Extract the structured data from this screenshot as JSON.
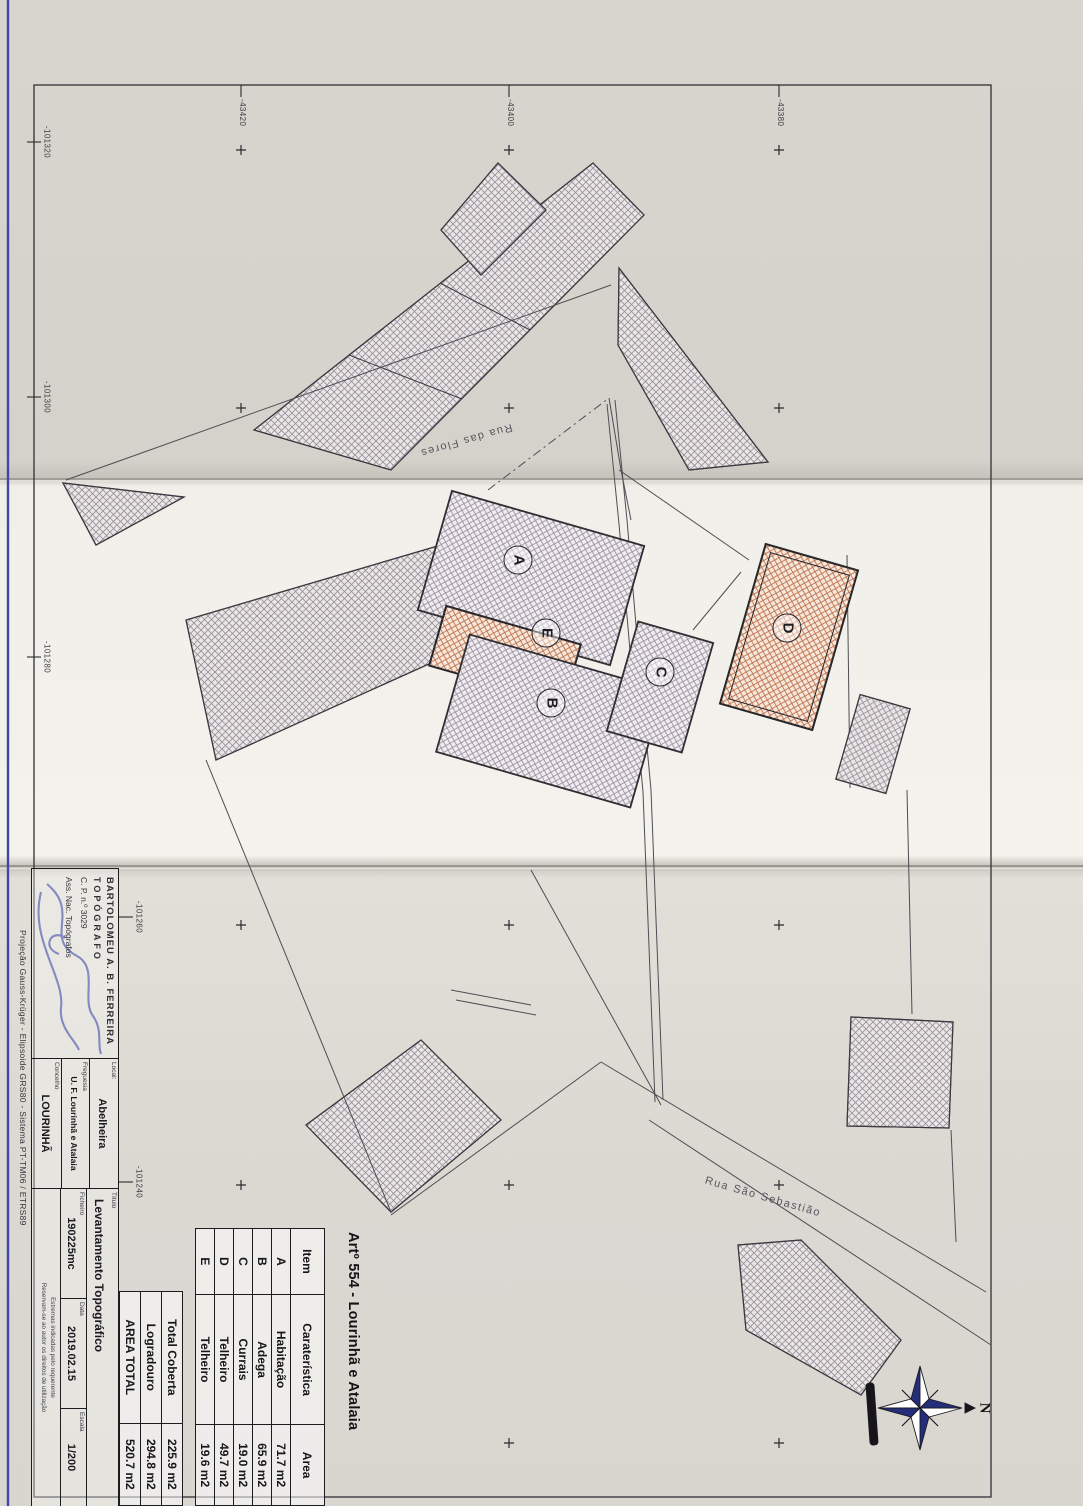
{
  "article": {
    "heading": "Artº 554 - Lourinhã e Atalaia"
  },
  "table": {
    "header": {
      "item": "Item",
      "carateristica": "Caraterística",
      "area": "Area"
    },
    "rows": [
      {
        "item": "A",
        "name": "Habitação",
        "area": "71.7 m2"
      },
      {
        "item": "B",
        "name": "Adega",
        "area": "65.9 m2"
      },
      {
        "item": "C",
        "name": "Currais",
        "area": "19.0 m2"
      },
      {
        "item": "D",
        "name": "Telheiro",
        "area": "49.7 m2"
      },
      {
        "item": "E",
        "name": "Telheiro",
        "area": "19.6 m2"
      }
    ],
    "totals": [
      {
        "label": "Total Coberta",
        "value": "225.9 m2"
      },
      {
        "label": "Logradouro",
        "value": "294.8 m2"
      },
      {
        "label": "AREA TOTAL",
        "value": "520.7 m2"
      }
    ]
  },
  "title_block": {
    "author_line1": "BARTOLOMEU A. B. FERREIRA",
    "author_line2": "TOPÓGRAFO",
    "author_line3": "C. P. n.º 3029",
    "author_line4": "Ass. Nac. Topógrafos",
    "local_label": "Local:",
    "local_value": "Abelheira",
    "freguesia_label": "Freguesia",
    "freguesia_value": "U. F. Lourinhã e Atalaia",
    "concelho_label": "Concelho",
    "concelho_value": "LOURINHÃ",
    "titulo_label": "Título",
    "titulo_value": "Levantamento Topográfico",
    "ficheiro_label": "Ficheiro",
    "ficheiro_value": "190225mc",
    "data_label": "Data",
    "data_value": "2019.02.15",
    "escala_label": "Escala",
    "escala_value": "1/200",
    "note1": "Estremas indicadas pelo requerente",
    "note2": "Reservam-se ao autor os direitos de utilização",
    "projection": "Projeção Gauss-Krüger - Elipsoide GRS80 - Sistema PT-TM06 / ETRS89"
  },
  "streets": {
    "flores": "Rua das Flores",
    "sebastiao": "Rua São Sebastião"
  },
  "grid": {
    "bottom_labels": [
      "-101320",
      "-101300",
      "-101280",
      "-101260",
      "-101240"
    ],
    "left_labels": [
      "-43420",
      "-43400",
      "-43380"
    ]
  },
  "buildings": {
    "a": "A",
    "b": "B",
    "c": "C",
    "d": "D",
    "e": "E"
  },
  "compass": {
    "north_label": "N"
  },
  "colors": {
    "hatch_gray": "#968da0",
    "hatch_orange": "#bc6a42",
    "ink": "#2a2a2e",
    "blue_ink": "#2b3a9e",
    "frame": "#3b3b40"
  }
}
